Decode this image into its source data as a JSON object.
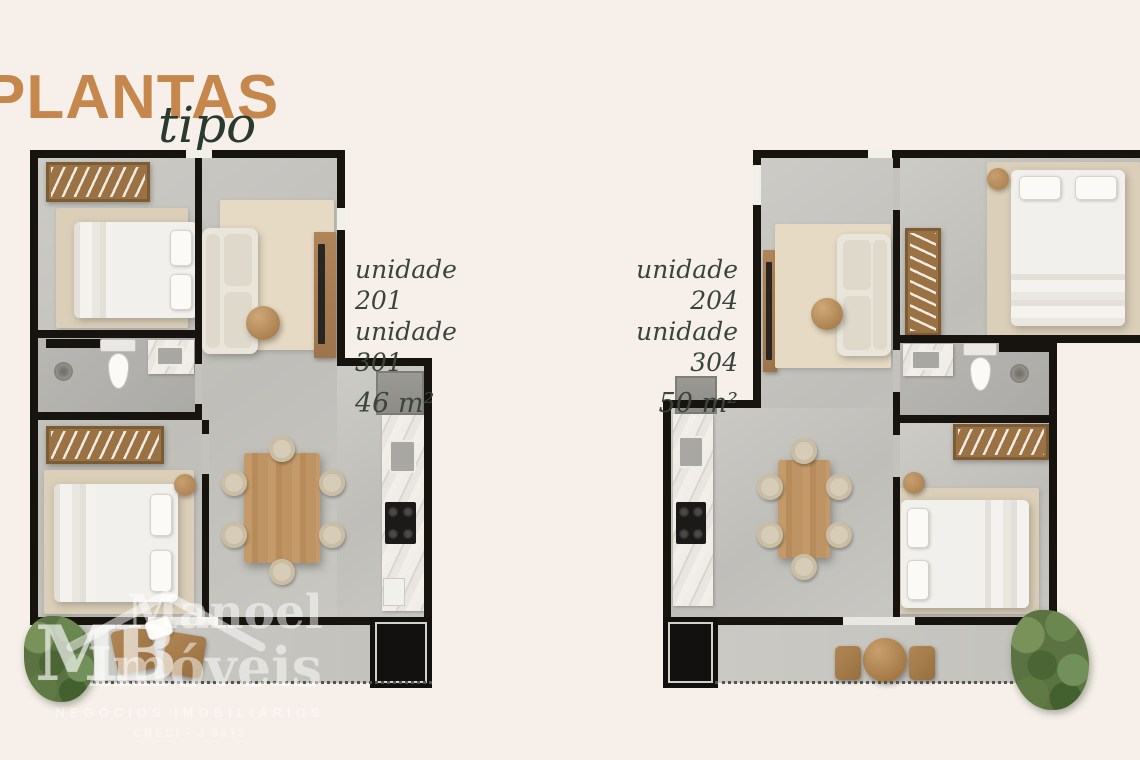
{
  "title": "PLANTAS",
  "subtitle": "tipo",
  "plans": [
    {
      "units": [
        "unidade 201",
        "unidade 301"
      ],
      "area": "46 m²"
    },
    {
      "units": [
        "unidade 204",
        "unidade 304"
      ],
      "area": "50 m²"
    }
  ],
  "watermark": {
    "logo_initials": "MB",
    "brand_line1": "Manoel",
    "brand_line2": "Imóveis",
    "tagline": "NEGÓCIOS IMOBILIÁRIOS",
    "registration": "CRECI - J 5313"
  },
  "icons": {
    "roof": "house-roof-outline-icon"
  },
  "colors": {
    "background": "#f7f0ea",
    "accent_orange": "#c6874d",
    "heading_green": "#2b3a2e",
    "label_text": "#39443a",
    "wall_black": "#17140f",
    "floor_gray": "#c6c5c0",
    "wood": "#b58a5d",
    "greenery": "#5b7342",
    "watermark_white": "#ffffff"
  }
}
